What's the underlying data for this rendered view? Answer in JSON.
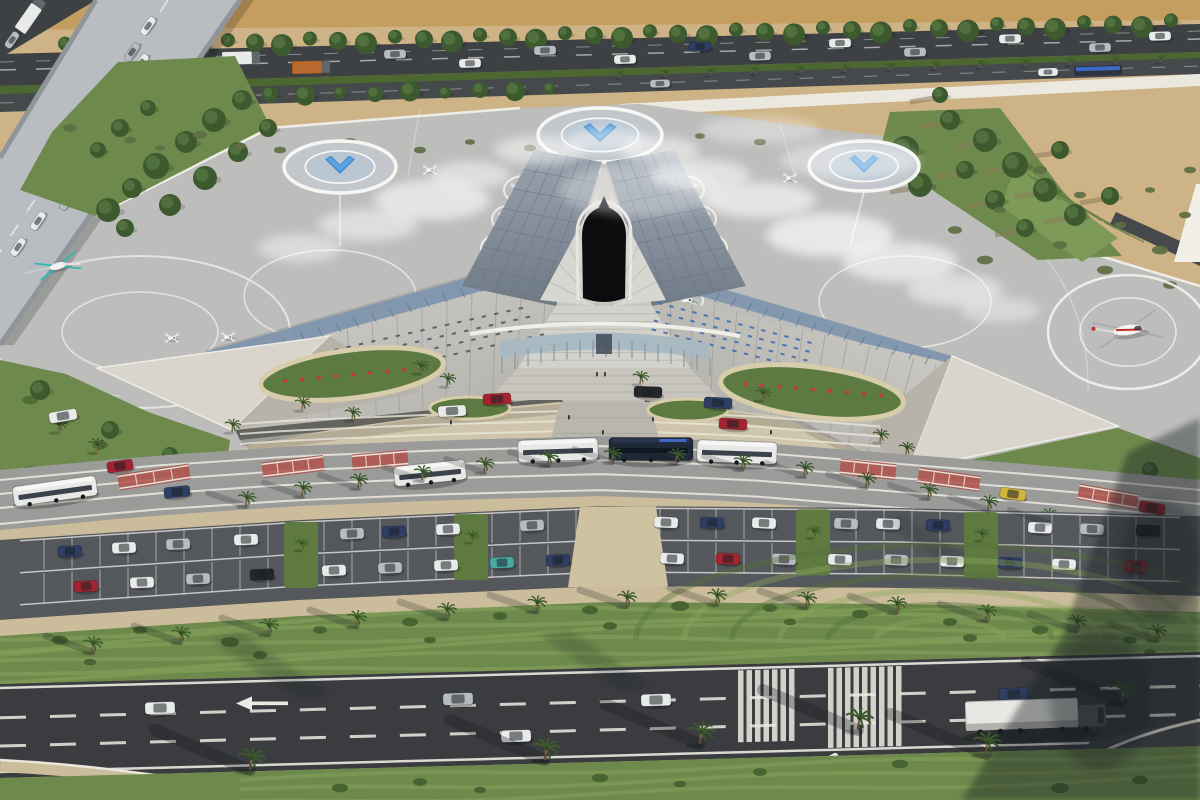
{
  "scene": {
    "description": "Aerial 3D architectural rendering of a futuristic star-shaped vertiport terminal in a desert setting: rooftop eVTOL landing pads with blue chevron helipads, two helicopters, a highway overpass at top-left, an entrance plaza with buses and drop-off cars, a large landscaped parking lot with palm trees, and a multi-lane road with a semi truck across the bottom.",
    "type": "architectural-aerial-rendering",
    "counts": {
      "helipads": 4,
      "evtol_aircraft": 9,
      "helicopters": 2,
      "buses": 6,
      "parked_cars": 34,
      "palm_trees": 58
    }
  },
  "palette": {
    "sand": "#cdb386",
    "sandDeep": "#c49e5f",
    "roadDark": "#3e4144",
    "roadMid": "#46494c",
    "ramp": "#b9bdc2",
    "apron": "#bdbdbb",
    "apronLine": "#f2f2ef",
    "grass": "#6d8a4c",
    "grassDeep": "#4c672f",
    "stripeLight": "#8ba55d",
    "treeDark": "#3d5a2f",
    "wall": "#ebe8e0",
    "roofLight": "#cac8c2",
    "roofDeep": "#aeaca6",
    "terrace": "#d9d5cc",
    "solar": "#7f96ad",
    "darkPanel": "#7b8694",
    "darkPanelHi": "#9aa3ae",
    "voidBlack": "#0c0c0e",
    "ribWhite": "#d8d6d1",
    "plaza": "#cfc5ac",
    "walkway": "#b9b6ad",
    "planterRim": "#d8cdab",
    "shrub": "#5d7a42",
    "flower": "#c23b35",
    "busLane": "#9b9b99",
    "crosswalkRed": "#b0524a",
    "sidewalk": "#cbbd9b",
    "parking": "#54575b",
    "highway": "#3a3c3f",
    "marking": "#eceae2",
    "helipadPad": "#c3c7cc",
    "helipadBlue": "#3e8ed2",
    "helipadBlueHi": "#74b3e6",
    "shadow": "#161a20",
    "trunk": "#7a6243",
    "carWhite": "#e9eaea",
    "carSilver": "#b7bcc2",
    "carDark": "#23262c",
    "carNavy": "#2e3f63",
    "carRed": "#a32430",
    "carTeal": "#49a8a2",
    "carYellow": "#d1b43c",
    "busWhite": "#e8e9e7",
    "busDark": "#202938",
    "heliRed": "#c03228",
    "heliTeal": "#2fb8b0"
  },
  "objects": {
    "helipads": [
      [
        340,
        167,
        56,
        26
      ],
      [
        600,
        135,
        62,
        27
      ],
      [
        864,
        166,
        55,
        25
      ]
    ],
    "helipad_ring_right": [
      1128,
      332,
      80,
      57
    ],
    "helicopter_right": [
      1128,
      330,
      -8
    ],
    "helicopter_left": [
      58,
      266,
      -15
    ],
    "evtols_left": [
      [
        520,
        190
      ],
      [
        508,
        219
      ],
      [
        497,
        248
      ],
      [
        487,
        277
      ],
      [
        521,
        300
      ]
    ],
    "evtols_right": [
      [
        688,
        190
      ],
      [
        700,
        219
      ],
      [
        711,
        248
      ],
      [
        721,
        277
      ],
      [
        687,
        300
      ]
    ],
    "evtols_far": [
      [
        172,
        338
      ],
      [
        228,
        337
      ],
      [
        430,
        170
      ],
      [
        790,
        178
      ]
    ],
    "ramp_vehicles": [
      [
        148,
        26,
        "w"
      ],
      [
        132,
        52,
        "s"
      ],
      [
        141,
        63,
        "w"
      ],
      [
        112,
        87,
        "s"
      ],
      [
        121,
        99,
        "w"
      ],
      [
        95,
        121,
        "y"
      ],
      [
        104,
        133,
        "s"
      ],
      [
        76,
        153,
        "w"
      ],
      [
        86,
        167,
        "w"
      ],
      [
        57,
        189,
        "r"
      ],
      [
        67,
        201,
        "s"
      ],
      [
        38,
        221,
        "w"
      ],
      [
        18,
        247,
        "w"
      ]
    ],
    "corner_vehicles": [
      [
        30,
        16,
        "w",
        1
      ],
      [
        12,
        40,
        "s",
        0
      ]
    ],
    "top_vehicles": [
      [
        85,
        -6,
        "w",
        1
      ],
      [
        150,
        5,
        "w",
        0
      ],
      [
        240,
        -6,
        "w",
        1
      ],
      [
        310,
        5,
        "o",
        1
      ],
      [
        395,
        -6,
        "s",
        0
      ],
      [
        470,
        5,
        "w",
        0
      ],
      [
        545,
        -6,
        "s",
        0
      ],
      [
        625,
        5,
        "w",
        0
      ],
      [
        700,
        -6,
        "n",
        0
      ],
      [
        760,
        5,
        "s",
        0
      ],
      [
        840,
        -6,
        "w",
        0
      ],
      [
        915,
        5,
        "s",
        0
      ],
      [
        1010,
        -6,
        "w",
        0
      ],
      [
        1100,
        5,
        "s",
        0
      ],
      [
        1160,
        -5,
        "w",
        0
      ]
    ],
    "road2_vehicles": [
      [
        660,
        "s"
      ],
      [
        1048,
        "w"
      ]
    ],
    "solar_bus_top": [
      1098,
      0
    ],
    "plaza_vehicles": [
      [
        497,
        399,
        -3,
        "r"
      ],
      [
        452,
        411,
        -3,
        "w"
      ],
      [
        648,
        392,
        2,
        "d"
      ],
      [
        718,
        403,
        3,
        "n"
      ],
      [
        733,
        424,
        4,
        "r"
      ],
      [
        63,
        416,
        -10,
        "w"
      ]
    ],
    "road_vehicles_mid": [
      [
        120,
        466,
        -8,
        "r"
      ],
      [
        177,
        492,
        -6,
        "n"
      ],
      [
        1013,
        494,
        8,
        "y"
      ],
      [
        1152,
        508,
        10,
        "r"
      ]
    ],
    "buses": [
      [
        430,
        473,
        72,
        20,
        "wh",
        -6
      ],
      [
        558,
        450,
        80,
        22,
        "wh",
        -2
      ],
      [
        651,
        449,
        84,
        23,
        "dk",
        0
      ],
      [
        737,
        452,
        80,
        22,
        "wh",
        2
      ],
      [
        55,
        491,
        84,
        20,
        "wh",
        -8
      ]
    ],
    "parked_cars": [
      [
        70,
        0,
        "n"
      ],
      [
        124,
        0,
        "w"
      ],
      [
        178,
        0,
        "s"
      ],
      [
        246,
        0,
        "w"
      ],
      [
        352,
        0,
        "s"
      ],
      [
        394,
        0,
        "n"
      ],
      [
        448,
        0,
        "w"
      ],
      [
        532,
        0,
        "s"
      ],
      [
        666,
        0,
        "w"
      ],
      [
        712,
        0,
        "n"
      ],
      [
        764,
        0,
        "w"
      ],
      [
        846,
        0,
        "s"
      ],
      [
        888,
        0,
        "w"
      ],
      [
        938,
        0,
        "n"
      ],
      [
        1040,
        0,
        "w"
      ],
      [
        1092,
        0,
        "s"
      ],
      [
        1148,
        0,
        "d"
      ],
      [
        86,
        1,
        "r"
      ],
      [
        142,
        1,
        "w"
      ],
      [
        198,
        1,
        "s"
      ],
      [
        262,
        1,
        "d"
      ],
      [
        334,
        1,
        "w"
      ],
      [
        390,
        1,
        "s"
      ],
      [
        446,
        1,
        "w"
      ],
      [
        502,
        1,
        "t"
      ],
      [
        558,
        1,
        "n"
      ],
      [
        672,
        1,
        "w"
      ],
      [
        728,
        1,
        "r"
      ],
      [
        784,
        1,
        "s"
      ],
      [
        840,
        1,
        "w"
      ],
      [
        896,
        1,
        "s"
      ],
      [
        952,
        1,
        "w"
      ],
      [
        1010,
        1,
        "n"
      ],
      [
        1064,
        1,
        "w"
      ],
      [
        1136,
        1,
        "r"
      ]
    ],
    "bottom_vehicles": [
      [
        160,
        708,
        -2,
        "w"
      ],
      [
        458,
        699,
        -2,
        "s"
      ],
      [
        656,
        700,
        -2,
        "w"
      ],
      [
        516,
        736,
        -2,
        "w"
      ],
      [
        1014,
        694,
        -2,
        "n"
      ],
      [
        826,
        764,
        -28,
        "w"
      ]
    ],
    "semi_truck": [
      1022,
      720,
      -2
    ],
    "crosswalks_red": [
      [
        118,
        2,
        72,
        -9
      ],
      [
        262,
        2,
        62,
        -7
      ],
      [
        352,
        0,
        56,
        -5
      ],
      [
        840,
        4,
        56,
        6
      ],
      [
        918,
        8,
        62,
        8
      ],
      [
        1078,
        12,
        60,
        10
      ]
    ],
    "zebras": [
      [
        738,
        7,
        8.5,
        5.5,
        6,
        16
      ],
      [
        828,
        9,
        8.5,
        5.5,
        6,
        8
      ]
    ],
    "palms_sidewalk": [
      [
        246,
        506
      ],
      [
        302,
        496
      ],
      [
        358,
        488
      ],
      [
        422,
        480
      ],
      [
        484,
        472
      ],
      [
        548,
        465
      ],
      [
        612,
        462
      ],
      [
        676,
        463
      ],
      [
        742,
        469
      ],
      [
        804,
        476
      ],
      [
        866,
        487
      ],
      [
        928,
        498
      ],
      [
        988,
        510
      ],
      [
        1048,
        523
      ]
    ],
    "palms_landscape": [
      [
        92,
        652
      ],
      [
        180,
        642
      ],
      [
        268,
        634
      ],
      [
        356,
        626
      ],
      [
        446,
        618
      ],
      [
        536,
        611
      ],
      [
        626,
        606
      ],
      [
        716,
        604
      ],
      [
        806,
        607
      ],
      [
        896,
        612
      ],
      [
        986,
        620
      ],
      [
        1076,
        630
      ],
      [
        1156,
        640
      ]
    ],
    "palms_plaza": [
      [
        420,
        373
      ],
      [
        447,
        386
      ],
      [
        640,
        384
      ],
      [
        762,
        400
      ],
      [
        302,
        410
      ],
      [
        352,
        420
      ],
      [
        880,
        442
      ],
      [
        232,
        432
      ],
      [
        906,
        455
      ]
    ],
    "palms_bottom": [
      [
        250,
        770
      ],
      [
        545,
        760
      ],
      [
        700,
        744
      ],
      [
        858,
        730
      ],
      [
        986,
        754
      ],
      [
        1122,
        702
      ]
    ],
    "palms_left": [
      [
        58,
        432
      ],
      [
        96,
        452
      ],
      [
        150,
        470
      ]
    ],
    "palms_right": [
      [
        962,
        502
      ],
      [
        1022,
        518
      ],
      [
        1118,
        540
      ]
    ],
    "palms_median": [
      620,
      665,
      710,
      755,
      800,
      845,
      890,
      935,
      980,
      1025,
      1070,
      1115,
      1160
    ],
    "trees_top_xs": [
      65,
      92,
      118,
      146,
      172,
      200,
      228,
      255,
      282,
      310,
      338,
      366,
      395,
      424,
      452,
      480,
      508,
      536,
      565,
      594,
      622,
      650,
      678,
      707,
      736,
      765,
      794,
      823,
      852,
      881,
      910,
      939,
      968,
      997,
      1026,
      1055,
      1084,
      1113,
      1142,
      1171
    ],
    "trees_mid_xs": [
      130,
      165,
      200,
      235,
      270,
      305,
      340,
      375,
      410,
      445,
      480,
      515,
      550
    ],
    "wedge_trees": [
      [
        108,
        210,
        12
      ],
      [
        132,
        188,
        10
      ],
      [
        156,
        166,
        13
      ],
      [
        186,
        142,
        11
      ],
      [
        214,
        120,
        12
      ],
      [
        242,
        100,
        10
      ],
      [
        125,
        228,
        9
      ],
      [
        170,
        205,
        11
      ],
      [
        205,
        178,
        12
      ],
      [
        238,
        152,
        10
      ],
      [
        268,
        128,
        9
      ],
      [
        98,
        150,
        8
      ],
      [
        120,
        128,
        9
      ],
      [
        148,
        108,
        8
      ]
    ],
    "slope_trees": [
      [
        950,
        120,
        10
      ],
      [
        985,
        140,
        12
      ],
      [
        1015,
        165,
        13
      ],
      [
        1045,
        190,
        12
      ],
      [
        1075,
        215,
        11
      ],
      [
        905,
        150,
        14
      ],
      [
        920,
        185,
        12
      ],
      [
        965,
        170,
        9
      ],
      [
        995,
        200,
        10
      ],
      [
        1025,
        228,
        9
      ],
      [
        940,
        95,
        8
      ],
      [
        1060,
        150,
        9
      ],
      [
        1110,
        196,
        9
      ],
      [
        880,
        165,
        10
      ]
    ],
    "sand_bushes": [
      [
        70,
        128,
        7
      ],
      [
        130,
        140,
        6
      ],
      [
        200,
        135,
        7
      ],
      [
        280,
        150,
        6
      ],
      [
        350,
        142,
        7
      ],
      [
        420,
        150,
        6
      ],
      [
        470,
        142,
        5
      ],
      [
        530,
        148,
        6
      ],
      [
        600,
        146,
        5
      ],
      [
        640,
        140,
        6
      ],
      [
        700,
        136,
        5
      ],
      [
        760,
        142,
        6
      ],
      [
        830,
        150,
        6
      ],
      [
        900,
        155,
        7
      ],
      [
        955,
        230,
        7
      ],
      [
        985,
        260,
        8
      ],
      [
        1000,
        210,
        6
      ],
      [
        1040,
        170,
        7
      ],
      [
        1060,
        245,
        7
      ],
      [
        1080,
        195,
        6
      ],
      [
        1105,
        270,
        8
      ],
      [
        1120,
        225,
        6
      ],
      [
        1160,
        250,
        8
      ],
      [
        1185,
        215,
        6
      ],
      [
        160,
        148,
        5
      ],
      [
        240,
        146,
        6
      ],
      [
        310,
        152,
        5
      ],
      [
        1150,
        190,
        5
      ],
      [
        1190,
        170,
        6
      ],
      [
        1170,
        285,
        7
      ]
    ],
    "landscape_bushes": [
      [
        60,
        640,
        8
      ],
      [
        140,
        630,
        7
      ],
      [
        230,
        642,
        9
      ],
      [
        320,
        630,
        7
      ],
      [
        410,
        622,
        8
      ],
      [
        500,
        616,
        7
      ],
      [
        590,
        610,
        8
      ],
      [
        680,
        606,
        9
      ],
      [
        770,
        608,
        7
      ],
      [
        860,
        614,
        8
      ],
      [
        950,
        622,
        7
      ],
      [
        1040,
        630,
        8
      ],
      [
        1130,
        640,
        7
      ],
      [
        90,
        662,
        6
      ],
      [
        260,
        655,
        7
      ],
      [
        430,
        640,
        6
      ],
      [
        610,
        626,
        7
      ],
      [
        790,
        622,
        6
      ],
      [
        970,
        638,
        7
      ],
      [
        1150,
        652,
        6
      ]
    ],
    "bottom_bushes": [
      [
        340,
        788,
        8
      ],
      [
        420,
        782,
        7
      ],
      [
        600,
        778,
        8
      ],
      [
        760,
        772,
        7
      ],
      [
        900,
        764,
        8
      ],
      [
        1060,
        788,
        9
      ],
      [
        1140,
        780,
        8
      ],
      [
        480,
        790,
        6
      ],
      [
        680,
        784,
        6
      ]
    ],
    "left_bushes": [
      [
        30,
        400,
        8
      ],
      [
        60,
        420,
        9
      ],
      [
        100,
        445,
        8
      ],
      [
        30,
        470,
        7
      ],
      [
        70,
        490,
        8
      ],
      [
        140,
        500,
        7
      ],
      [
        180,
        514,
        6
      ],
      [
        40,
        518,
        7
      ],
      [
        200,
        460,
        6
      ],
      [
        120,
        470,
        7
      ]
    ],
    "right_bushes": [
      [
        940,
        490,
        7
      ],
      [
        980,
        505,
        8
      ],
      [
        1030,
        512,
        7
      ],
      [
        1080,
        510,
        6
      ],
      [
        1000,
        515,
        6
      ],
      [
        952,
        512,
        6
      ],
      [
        1100,
        498,
        6
      ]
    ],
    "clouds": [
      [
        300,
        248,
        42,
        14,
        0.45
      ],
      [
        368,
        225,
        50,
        16,
        0.5
      ],
      [
        432,
        200,
        58,
        20,
        0.6
      ],
      [
        470,
        175,
        40,
        14,
        0.5
      ],
      [
        540,
        150,
        46,
        14,
        0.5
      ],
      [
        608,
        140,
        40,
        12,
        0.45
      ],
      [
        660,
        150,
        40,
        13,
        0.5
      ],
      [
        700,
        175,
        50,
        16,
        0.55
      ],
      [
        760,
        200,
        56,
        18,
        0.6
      ],
      [
        830,
        235,
        64,
        22,
        0.65
      ],
      [
        900,
        262,
        58,
        20,
        0.6
      ],
      [
        955,
        290,
        48,
        16,
        0.5
      ],
      [
        1000,
        310,
        40,
        13,
        0.4
      ],
      [
        640,
        190,
        80,
        26,
        0.3
      ],
      [
        760,
        130,
        60,
        14,
        0.35
      ],
      [
        850,
        160,
        70,
        18,
        0.4
      ]
    ],
    "people": [
      [
        602,
        430
      ],
      [
        612,
        444
      ],
      [
        568,
        415
      ],
      [
        652,
        417
      ],
      [
        590,
        455
      ],
      [
        620,
        468
      ],
      [
        450,
        420
      ],
      [
        770,
        430
      ],
      [
        604,
        372
      ],
      [
        596,
        372
      ]
    ]
  }
}
